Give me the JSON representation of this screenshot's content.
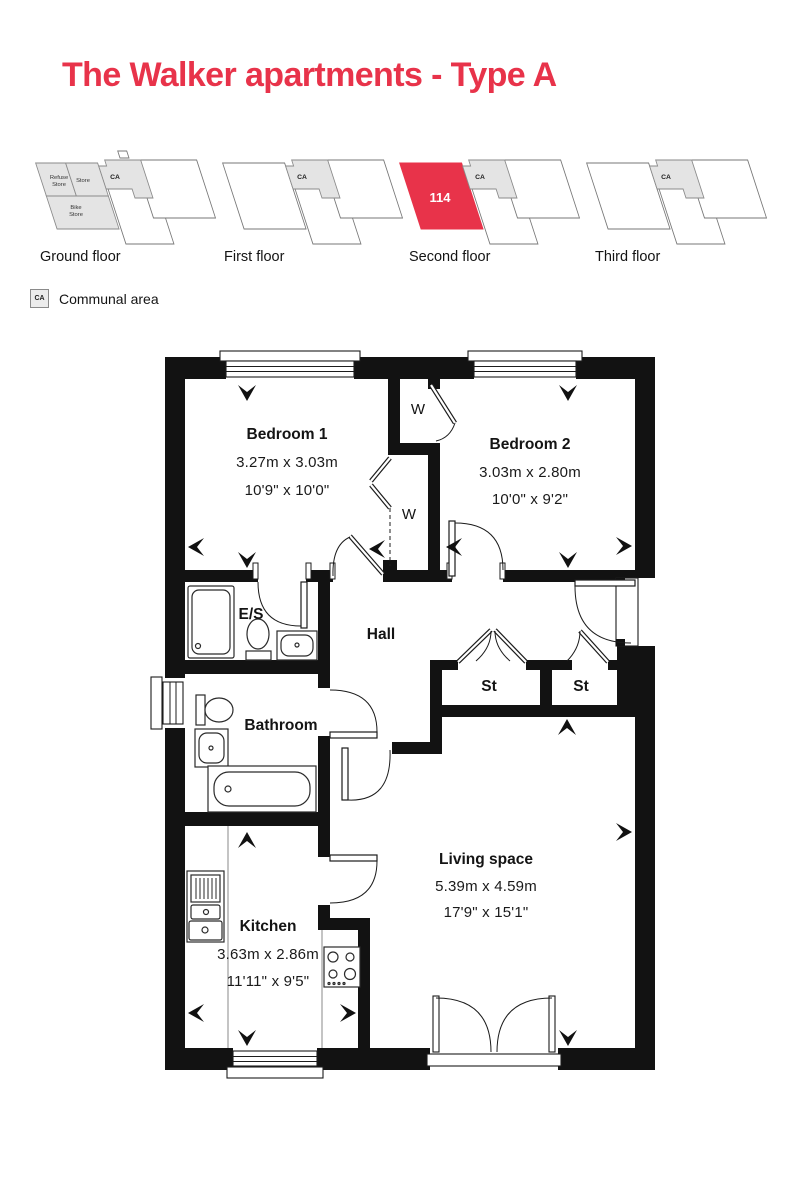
{
  "title": "The Walker apartments - Type A",
  "colors": {
    "accent": "#e8334a",
    "wall": "#121212",
    "communal_fill": "#e4e4e4"
  },
  "floor_selector": {
    "floors": [
      {
        "label": "Ground floor",
        "communal_label": "CA",
        "refuse_store": [
          "Refuse",
          "Store"
        ],
        "store": "Store",
        "bike_store": [
          "Bike",
          "Store"
        ]
      },
      {
        "label": "First floor",
        "communal_label": "CA"
      },
      {
        "label": "Second floor",
        "communal_label": "CA",
        "unit_number": "114"
      },
      {
        "label": "Third floor",
        "communal_label": "CA"
      }
    ]
  },
  "legend": {
    "symbol": "CA",
    "label": "Communal area"
  },
  "plan": {
    "rooms": {
      "bedroom1": {
        "name": "Bedroom 1",
        "metric": "3.27m x 3.03m",
        "imperial": "10'9\" x 10'0\""
      },
      "bedroom2": {
        "name": "Bedroom 2",
        "metric": "3.03m x 2.80m",
        "imperial": "10'0\" x 9'2\""
      },
      "kitchen": {
        "name": "Kitchen",
        "metric": "3.63m x 2.86m",
        "imperial": "11'11\" x 9'5\""
      },
      "living": {
        "name": "Living space",
        "metric": "5.39m x 4.59m",
        "imperial": "17'9\" x 15'1\""
      },
      "hall": {
        "name": "Hall"
      },
      "bathroom": {
        "name": "Bathroom"
      },
      "ensuite": {
        "name": "E/S"
      },
      "store1": {
        "name": "St"
      },
      "store2": {
        "name": "St"
      },
      "wardrobe1": {
        "name": "W"
      },
      "wardrobe2": {
        "name": "W"
      }
    }
  }
}
